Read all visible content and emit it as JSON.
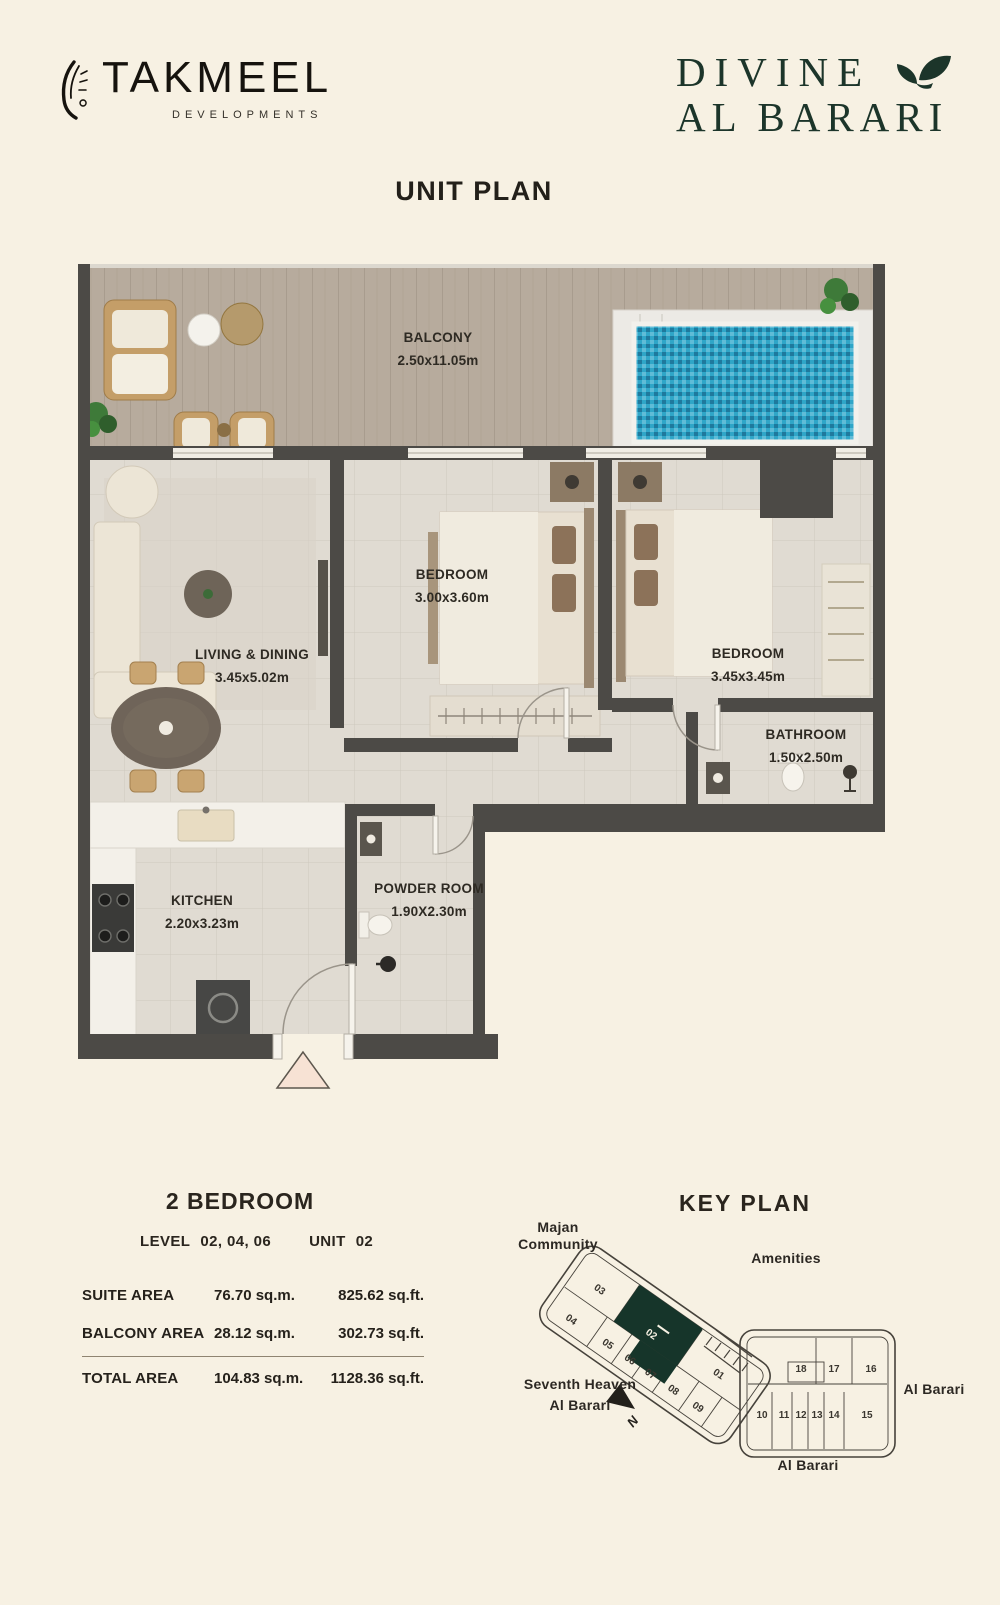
{
  "header": {
    "brand": {
      "name": "TAKMEEL",
      "tagline": "DEVELOPMENTS"
    },
    "project": {
      "line1": "DIVINE",
      "line2": "AL BARARI"
    },
    "title": "UNIT PLAN"
  },
  "colors": {
    "background": "#f7f1e3",
    "ink": "#23201a",
    "brand_green": "#16352a",
    "wall": "#4c4a46",
    "pool_water": "#2fa6c8",
    "balcony_wood": "#b7ab9d",
    "interior_floor": "#e0dbd2",
    "entry_marker": "#f7e2d4"
  },
  "plan": {
    "rooms": {
      "balcony": {
        "name": "BALCONY",
        "dims": "2.50x11.05m"
      },
      "bedroom1": {
        "name": "BEDROOM",
        "dims": "3.00x3.60m"
      },
      "bedroom2": {
        "name": "BEDROOM",
        "dims": "3.45x3.45m"
      },
      "living": {
        "name": "LIVING & DINING",
        "dims": "3.45x5.02m"
      },
      "bathroom": {
        "name": "BATHROOM",
        "dims": "1.50x2.50m"
      },
      "kitchen": {
        "name": "KITCHEN",
        "dims": "2.20x3.23m"
      },
      "powder": {
        "name": "POWDER ROOM",
        "dims": "1.90X2.30m"
      }
    }
  },
  "details": {
    "unit_type": "2 BEDROOM",
    "level_label": "LEVEL",
    "level_value": "02, 04, 06",
    "unit_label": "UNIT",
    "unit_value": "02",
    "areas": [
      {
        "label": "SUITE AREA",
        "sqm": "76.70 sq.m.",
        "sqft": "825.62  sq.ft."
      },
      {
        "label": "BALCONY AREA",
        "sqm": "28.12 sq.m.",
        "sqft": "302.73  sq.ft."
      },
      {
        "label": "TOTAL AREA",
        "sqm": "104.83 sq.m.",
        "sqft": "1128.36  sq.ft."
      }
    ]
  },
  "keyplan": {
    "title": "KEY PLAN",
    "highlighted_unit": "02",
    "labels": {
      "majan_1": "Majan",
      "majan_2": "Community",
      "amenities": "Amenities",
      "seventh_1": "Seventh Heaven",
      "seventh_2": "Al Barari",
      "albarari_right": "Al Barari",
      "albarari_bottom": "Al Barari",
      "north": "N"
    },
    "wing_a_units": [
      "03",
      "02",
      "04",
      "01",
      "05",
      "06",
      "07",
      "08",
      "09"
    ],
    "wing_b_top": [
      "18",
      "17",
      "16"
    ],
    "wing_b_bottom": [
      "10",
      "11",
      "12",
      "13",
      "14",
      "15"
    ]
  }
}
